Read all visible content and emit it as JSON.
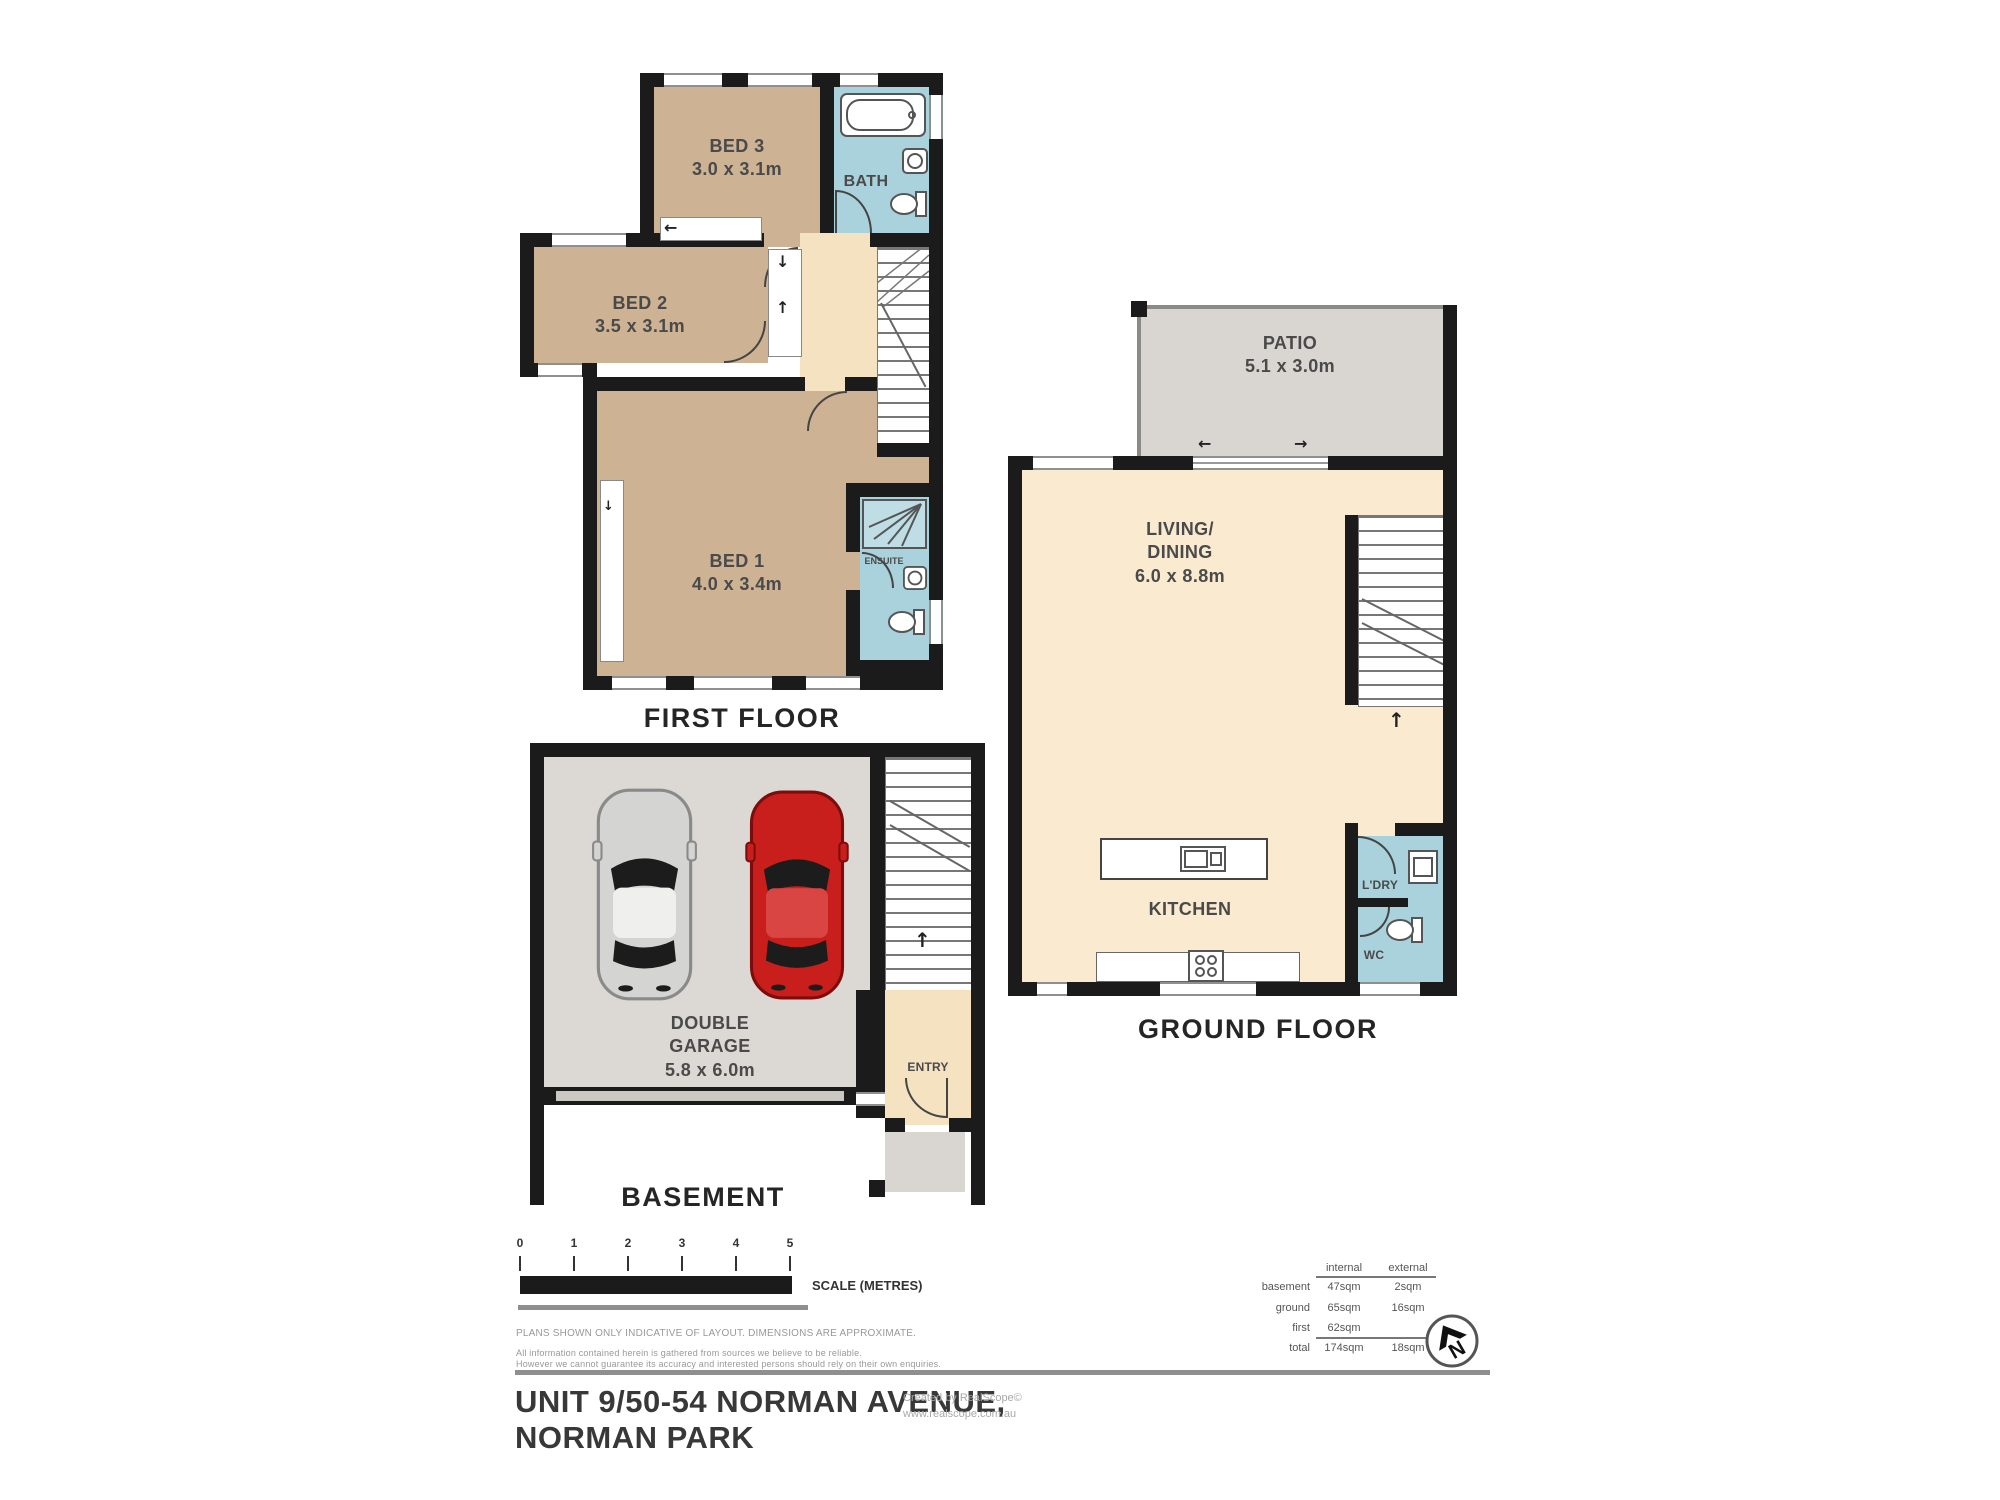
{
  "doc": {
    "title_line1": "UNIT 9/50-54 NORMAN AVENUE,",
    "title_line2": "NORMAN PARK",
    "credit_line1": "Created by RealScope©",
    "credit_line2": "www.realscope.com.au"
  },
  "first_floor": {
    "label": "FIRST FLOOR",
    "bed3_name": "BED 3",
    "bed3_dims": "3.0 x 3.1m",
    "bath_name": "BATH",
    "bed2_name": "BED 2",
    "bed2_dims": "3.5 x 3.1m",
    "bed1_name": "BED 1",
    "bed1_dims": "4.0 x 3.4m",
    "ensuite_name": "ENSUITE"
  },
  "ground_floor": {
    "label": "GROUND FLOOR",
    "patio_name": "PATIO",
    "patio_dims": "5.1 x 3.0m",
    "living_name1": "LIVING/",
    "living_name2": "DINING",
    "living_dims": "6.0 x 8.8m",
    "kitchen_name": "KITCHEN",
    "laundry_name": "L'DRY",
    "wc_name": "WC"
  },
  "basement": {
    "label": "BASEMENT",
    "garage_name1": "DOUBLE",
    "garage_name2": "GARAGE",
    "garage_dims": "5.8 x 6.0m",
    "entry_name": "ENTRY"
  },
  "scale_bar": {
    "marks": [
      "0",
      "1",
      "2",
      "3",
      "4",
      "5"
    ],
    "label": "SCALE (METRES)"
  },
  "disclaimer": {
    "line1": "PLANS SHOWN ONLY INDICATIVE OF LAYOUT.  DIMENSIONS ARE APPROXIMATE.",
    "line2": "All information contained herein is gathered from sources we believe to be reliable.",
    "line3": "However we cannot guarantee its accuracy and interested persons should rely on their own enquiries."
  },
  "areas": {
    "col_internal": "internal",
    "col_external": "external",
    "rows": [
      {
        "label": "basement",
        "internal": "47sqm",
        "external": "2sqm"
      },
      {
        "label": "ground",
        "internal": "65sqm",
        "external": "16sqm"
      },
      {
        "label": "first",
        "internal": "62sqm",
        "external": ""
      },
      {
        "label": "total",
        "internal": "174sqm",
        "external": "18sqm"
      }
    ]
  },
  "north_label": "N",
  "colors": {
    "wall": "#1b1b1b",
    "bedroom_tan": "#cdb293",
    "hall_cream": "#f5e2c1",
    "living_cream": "#f9ead0",
    "wet_area_blue": "#a9d2dc",
    "patio_grey": "#d9d6d2",
    "garage_grey": "#dcd8d4",
    "car_red": "#c81e1c",
    "car_silver": "#d4d4d2",
    "scale_bar_black": "#1b1b1b",
    "rule_grey": "#8f8f8f"
  }
}
